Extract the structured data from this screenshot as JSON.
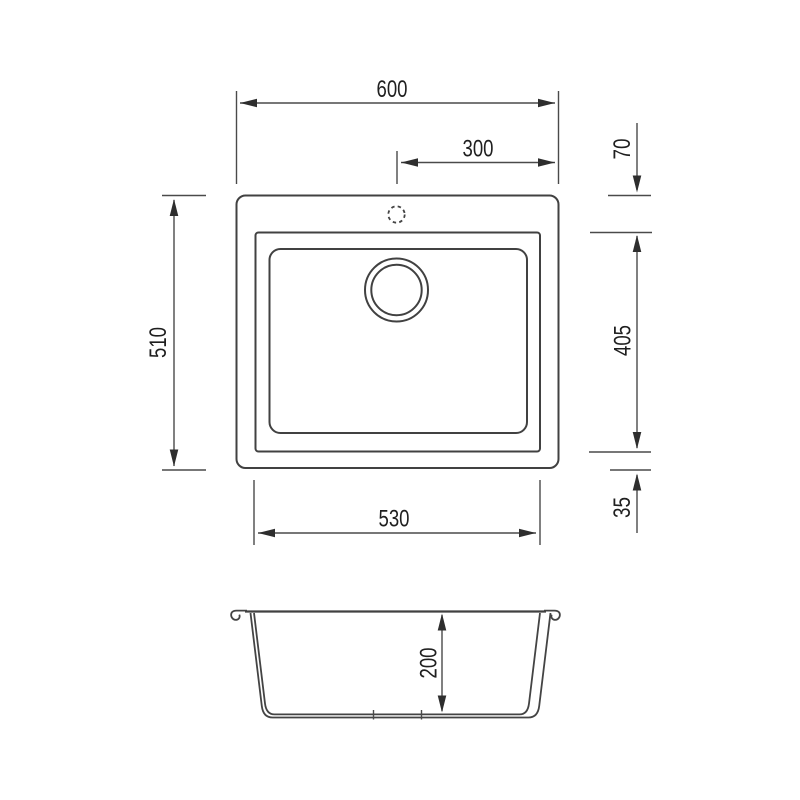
{
  "page": {
    "background_color": "#ffffff",
    "line_color": "#414141",
    "text_color": "#1f1f1f"
  },
  "drawing": {
    "dimensions": {
      "overall_width": "600",
      "tap_hole_offset": "300",
      "rim_top_gap": "70",
      "overall_depth": "510",
      "bowl_length": "405",
      "rim_bottom_gap": "35",
      "bowl_width": "530",
      "bowl_depth": "200"
    }
  }
}
